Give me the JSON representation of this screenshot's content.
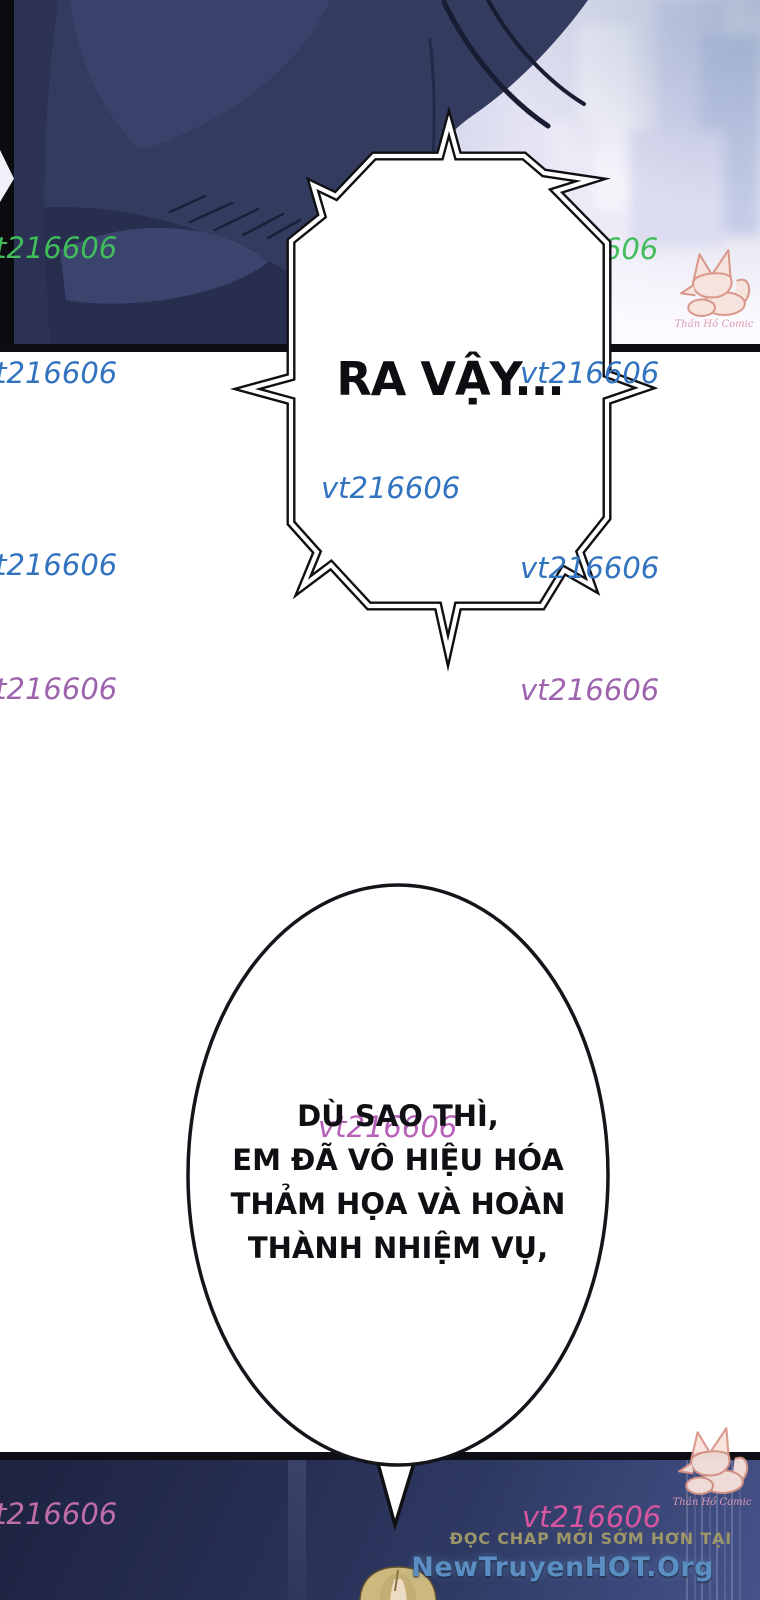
{
  "comic": {
    "bubble1": {
      "text": "RA VẬY..."
    },
    "bubble2": {
      "lines": [
        "DÙ SAO THÌ,",
        "EM ĐÃ VÔ HIỆU HÓA",
        "THẢM HỌA VÀ HOÀN",
        "THÀNH NHIỆM VỤ,"
      ]
    }
  },
  "watermark": {
    "text": "vt216606",
    "colors": {
      "green": "#41bd5c",
      "blue": "#3273c0",
      "purple": "#9d63ad",
      "magenta": "#b860b8",
      "pink": "#c06da8",
      "hotpink": "#d8569f"
    }
  },
  "branding": {
    "fox_credit": "Thần Hồ Comic",
    "promo_text": "ĐỌC CHAP MỚI SỚM HƠN TẠI",
    "promo_color": "#9c9668",
    "site_name": "NewTruyenHOT.Org",
    "site_color": "#5b8fc4"
  }
}
